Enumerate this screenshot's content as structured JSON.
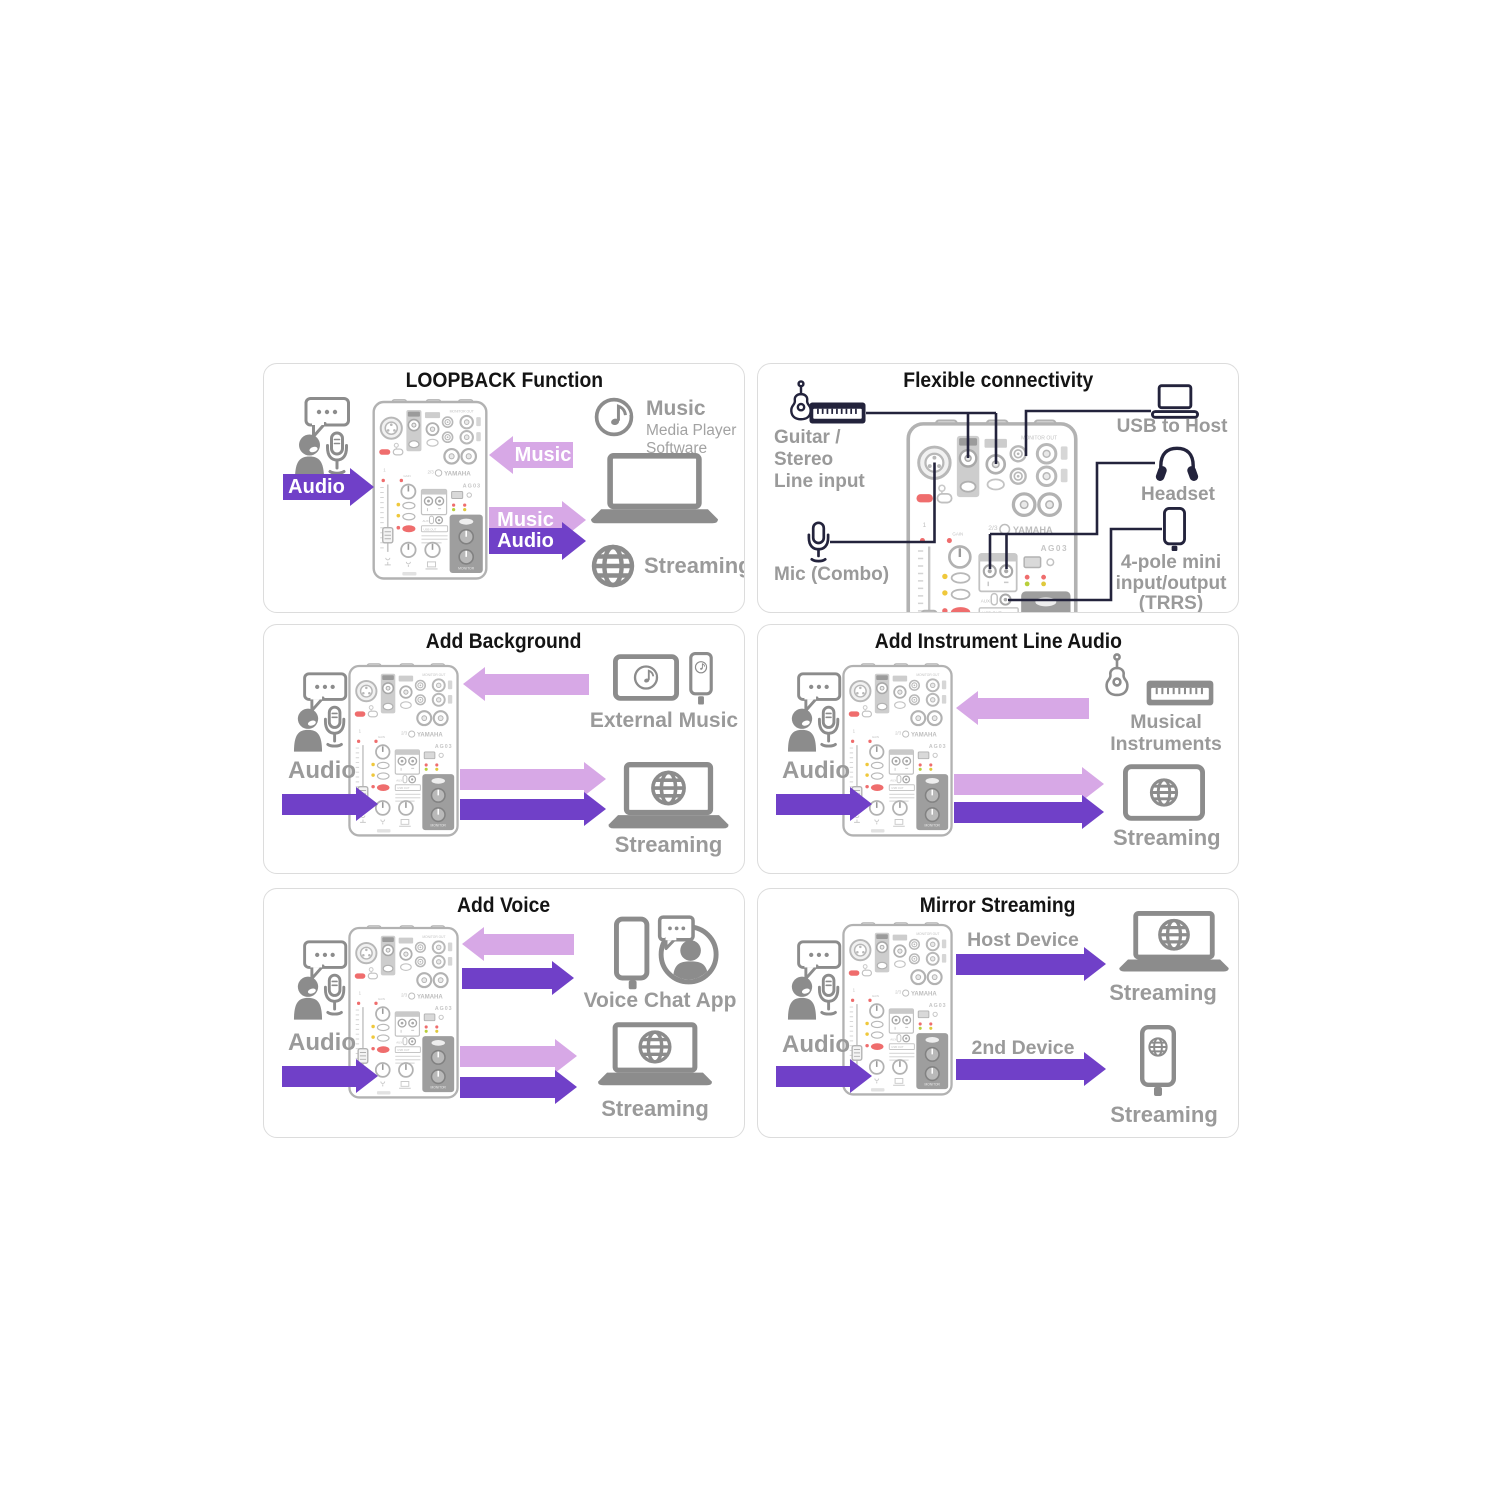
{
  "colors": {
    "purple": "#7040c8",
    "lilac": "#d7a8e6",
    "label_gray": "#9a9a9a",
    "icon_gray": "#8c8c8c",
    "wire_navy": "#23233c",
    "mixer_red": "#ef6d6d",
    "mixer_yellow": "#efc83c",
    "mixer_green": "#b8cf3a"
  },
  "p1": {
    "title": "LOOPBACK Function",
    "audio_in": "Audio",
    "music_in": "Music",
    "music_out": "Music",
    "audio_out": "Audio",
    "music_app": "Music",
    "music_app_sub1": "Media Player",
    "music_app_sub2": "Software",
    "streaming": "Streaming"
  },
  "p2": {
    "title": "Flexible connectivity",
    "guitar1": "Guitar /",
    "guitar2": "Stereo",
    "guitar3": "Line input",
    "mic": "Mic (Combo)",
    "usb": "USB to Host",
    "headset": "Headset",
    "trrs1": "4-pole mini",
    "trrs2": "input/output",
    "trrs3": "(TRRS)"
  },
  "p3": {
    "title": "Add Background",
    "audio": "Audio",
    "source": "External Music",
    "streaming": "Streaming"
  },
  "p4": {
    "title": "Add Instrument Line Audio",
    "audio": "Audio",
    "source1": "Musical",
    "source2": "Instruments",
    "streaming": "Streaming"
  },
  "p5": {
    "title": "Add Voice",
    "audio": "Audio",
    "source": "Voice Chat App",
    "streaming": "Streaming"
  },
  "p6": {
    "title": "Mirror Streaming",
    "audio": "Audio",
    "host": "Host Device",
    "second": "2nd Device",
    "streaming_host": "Streaming",
    "streaming_second": "Streaming"
  },
  "mixer": {
    "brand": "YAMAHA",
    "model": "AG03",
    "monitor_out": "MONITOR OUT",
    "ch1": "1",
    "ch23": "2/3",
    "gain": "GAIN",
    "aux": "AUX",
    "usb_out": "USB OUT",
    "monitor": "MONITOR"
  }
}
